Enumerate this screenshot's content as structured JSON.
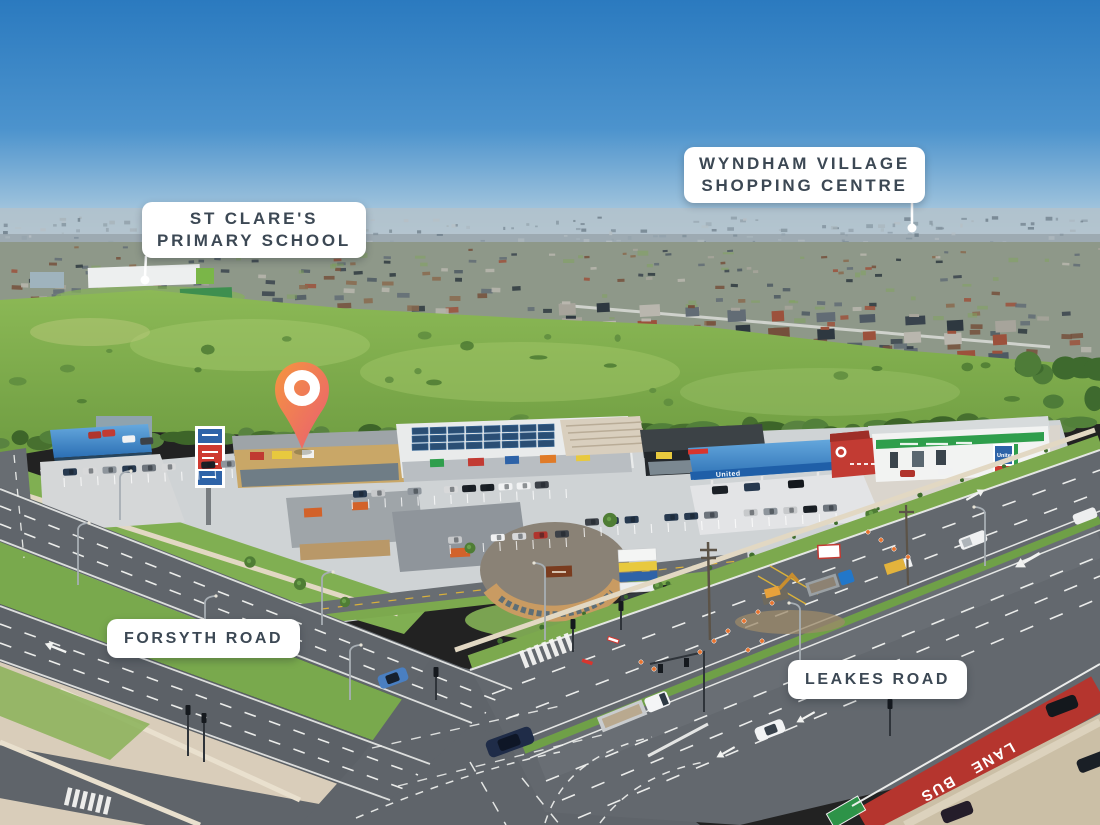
{
  "callouts": {
    "school": {
      "line1": "ST CLARE'S",
      "line2": "PRIMARY SCHOOL"
    },
    "shopping_centre": {
      "line1": "WYNDHAM VILLAGE",
      "line2": "SHOPPING CENTRE"
    },
    "forsyth_road": {
      "label": "FORSYTH ROAD"
    },
    "leakes_road": {
      "label": "LEAKES ROAD"
    }
  },
  "road_markings": {
    "bus_lane_word1": "BUS",
    "bus_lane_word2": "LANE"
  },
  "signage": {
    "fuel_brand": "United"
  },
  "pin": {
    "gradient_top": "#F5953F",
    "gradient_bottom": "#E95E72"
  },
  "palette": {
    "sky_top": "#2B7ABF",
    "sky_horizon": "#B9D2E1",
    "field_green": "#8CB956",
    "label_bg": "#FFFFFF",
    "label_text": "#3C4854",
    "asphalt": "#5F646A",
    "bus_lane_red": "#B5352E",
    "canopy_blue": "#2E7DC2",
    "concrete_path": "#D9CDBA",
    "pin_orange": "#F5953F",
    "pin_pink": "#E95E72"
  }
}
